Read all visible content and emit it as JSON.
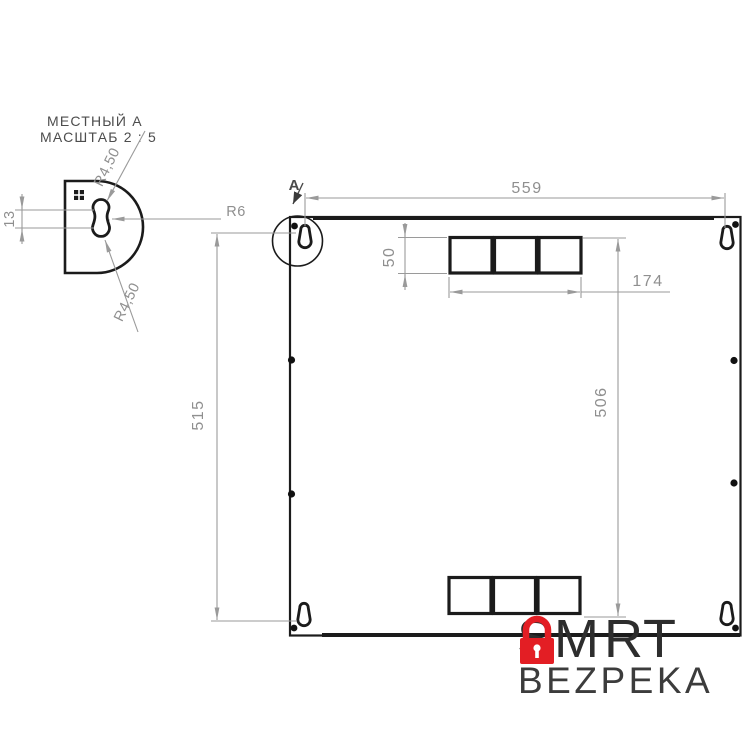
{
  "detail_view": {
    "title_line1": "МЕСТНЫЙ А",
    "title_line2": "МАСШТАБ 2 : 5",
    "dim_slot_height": "13",
    "dim_radius_top": "R4,50",
    "dim_radius_bottom": "R4,50",
    "dim_radius_right": "R6"
  },
  "main_view": {
    "detail_label": "A",
    "dim_width": "559",
    "dim_height": "515",
    "dim_cutout_height": "50",
    "dim_cutout_width": "174",
    "dim_cutout_span": "506"
  },
  "watermark": {
    "brand_prefix": "SM",
    "brand_suffix": "RT",
    "subtitle": "BEZPEKA",
    "lock_color": "#e31e24"
  },
  "colors": {
    "drawing_line": "#1b1b1b",
    "dimension_line": "#9a9a9a",
    "dimension_text": "#8f8f8f"
  }
}
